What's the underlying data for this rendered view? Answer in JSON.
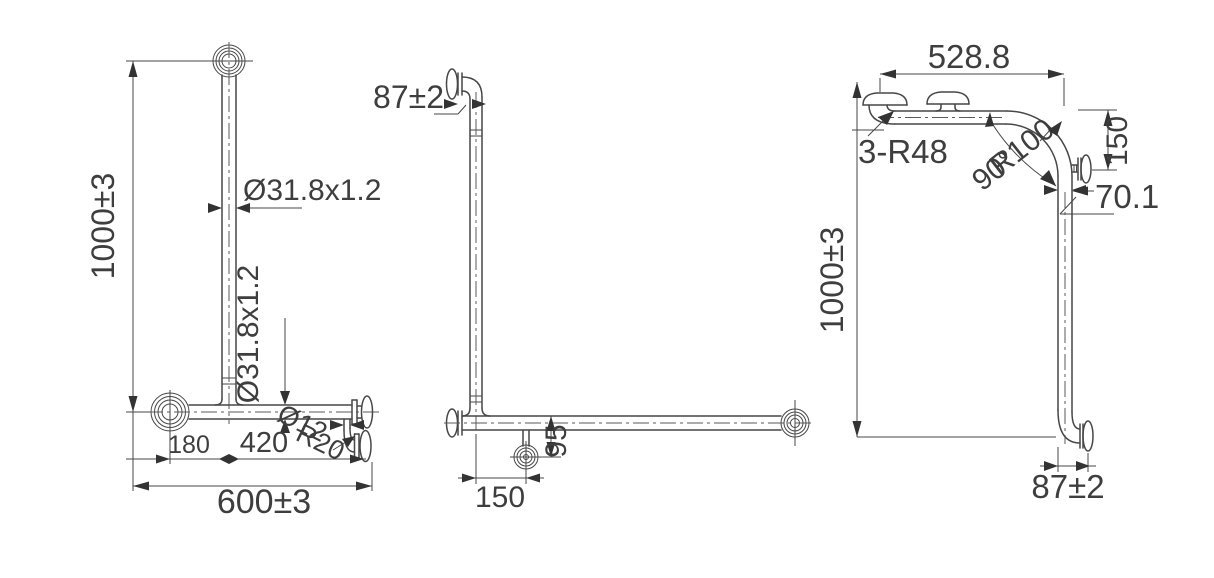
{
  "drawing": {
    "title": "grab-bar-technical-drawing",
    "background": "#ffffff",
    "line_color": "#474747",
    "text_color": "#3e3e3e",
    "views": {
      "front": {
        "dim_height": "1000±3",
        "tube_dia_vertical": "Ø31.8x1.2",
        "tube_dia_horizontal": "Ø31.8x1.2",
        "support_dia": "Ø12",
        "support_bend_radius": "R20",
        "dim_left_offset": "180",
        "dim_mid_span": "420",
        "dim_width": "600±3"
      },
      "side": {
        "dim_wall_offset": "87±2",
        "dim_support_drop": "95",
        "dim_support_offset": "150"
      },
      "rear": {
        "dim_top_width": "528.8",
        "mount_bend_radius": "3-R48",
        "main_bend_radius": "R100",
        "bend_angle": "90°",
        "dim_flange_drop": "150",
        "dim_center_span": "70.1",
        "dim_height": "1000±3",
        "dim_wall_offset": "87±2"
      }
    }
  }
}
